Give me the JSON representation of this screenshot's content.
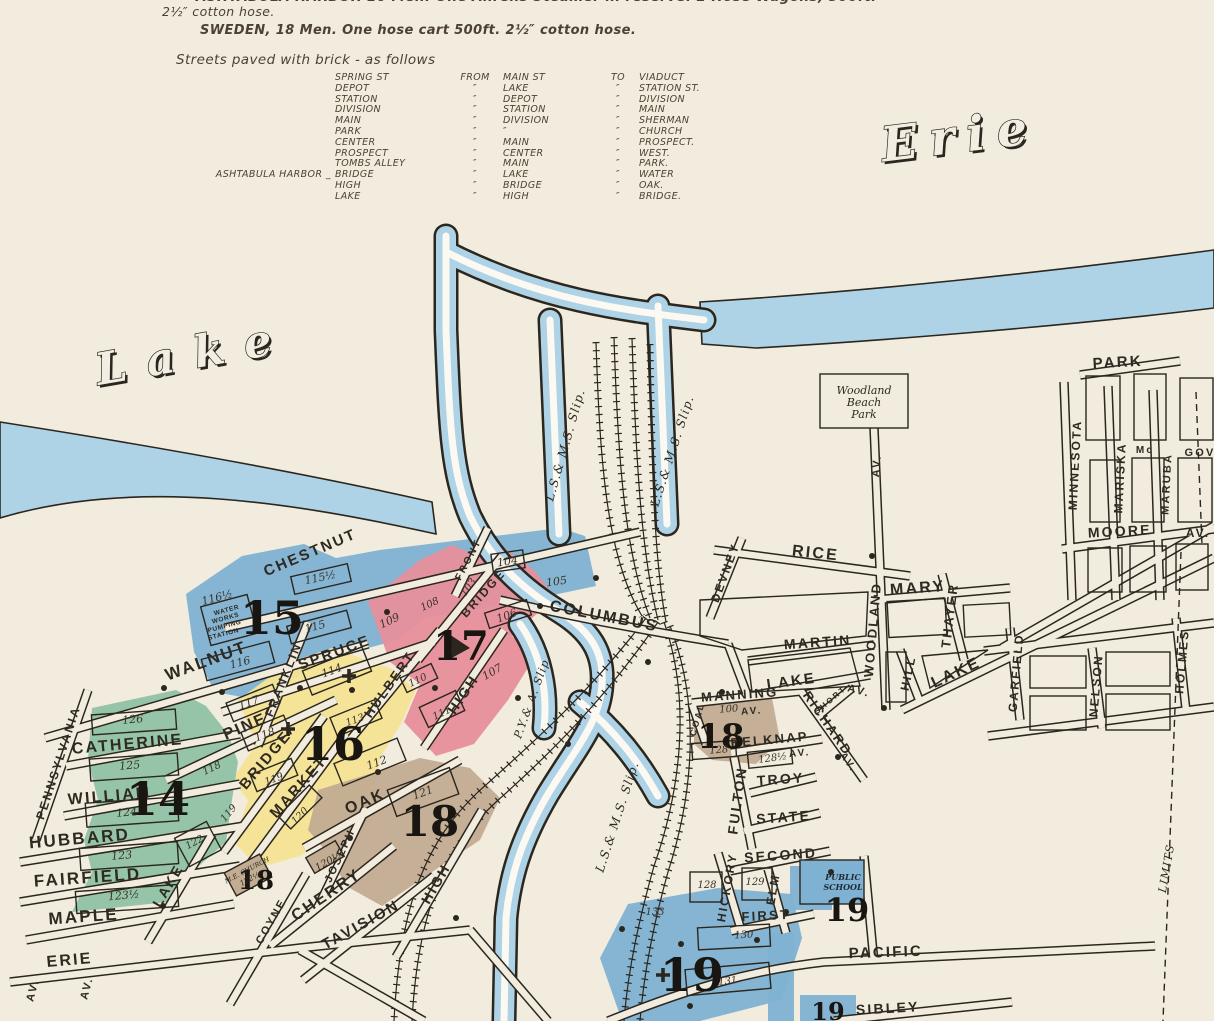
{
  "palette": {
    "paper": "#f1ecdd",
    "ink": "#2b261e",
    "text": "#4c4132",
    "water": "#aed2e6",
    "district_blue": "#7fb2d2",
    "district_pink": "#e78f9b",
    "district_yellow": "#f4e494",
    "district_green": "#90c2a4",
    "district_tan": "#c2ac92"
  },
  "header": {
    "line1": "ASHTABULA HARBOR 16 Men. One Ahrens Steamer in reserve. 2 Hose Wagons, 500ft.",
    "line2": "2½″ cotton hose.",
    "line3": "SWEDEN, 18 Men. One hose cart 500ft. 2½″ cotton hose.",
    "paved": {
      "title": "Streets paved with brick - as follows",
      "rows": [
        {
          "prefix": "",
          "street": "SPRING ST",
          "from": "FROM",
          "main": "MAIN ST",
          "to": "TO",
          "dest": "VIADUCT"
        },
        {
          "prefix": "",
          "street": "DEPOT",
          "from": "″",
          "main": "LAKE",
          "to": "″",
          "dest": "STATION ST."
        },
        {
          "prefix": "",
          "street": "STATION",
          "from": "″",
          "main": "DEPOT",
          "to": "″",
          "dest": "DIVISION"
        },
        {
          "prefix": "",
          "street": "DIVISION",
          "from": "″",
          "main": "STATION",
          "to": "″",
          "dest": "MAIN"
        },
        {
          "prefix": "",
          "street": "MAIN",
          "from": "″",
          "main": "DIVISION",
          "to": "″",
          "dest": "SHERMAN"
        },
        {
          "prefix": "",
          "street": "PARK",
          "from": "″",
          "main": "″",
          "to": "″",
          "dest": "CHURCH"
        },
        {
          "prefix": "",
          "street": "CENTER",
          "from": "″",
          "main": "MAIN",
          "to": "″",
          "dest": "PROSPECT."
        },
        {
          "prefix": "",
          "street": "PROSPECT",
          "from": "″",
          "main": "CENTER",
          "to": "″",
          "dest": "WEST."
        },
        {
          "prefix": "",
          "street": "TOMBS ALLEY",
          "from": "″",
          "main": "MAIN",
          "to": "″",
          "dest": "PARK."
        },
        {
          "prefix": "ASHTABULA HARBOR _",
          "street": "BRIDGE",
          "from": "″",
          "main": "LAKE",
          "to": "″",
          "dest": "WATER"
        },
        {
          "prefix": "",
          "street": "HIGH",
          "from": "″",
          "main": "BRIDGE",
          "to": "″",
          "dest": "OAK."
        },
        {
          "prefix": "",
          "street": "LAKE",
          "from": "″",
          "main": "HIGH",
          "to": "″",
          "dest": "BRIDGE."
        }
      ]
    }
  },
  "map": {
    "labels": [
      {
        "t": "Lake",
        "x": 196,
        "y": 368,
        "r": -10,
        "s": 44,
        "c": "water",
        "ls": 20
      },
      {
        "t": "Erie",
        "x": 962,
        "y": 152,
        "r": -7,
        "s": 48,
        "c": "water",
        "ls": 12
      },
      {
        "t": "CHESTNUT",
        "x": 312,
        "y": 557,
        "r": -23,
        "s": 15,
        "c": "st"
      },
      {
        "t": "WALNUT",
        "x": 208,
        "y": 666,
        "r": -20,
        "s": 17,
        "c": "st"
      },
      {
        "t": "SPRUCE",
        "x": 336,
        "y": 657,
        "r": -20,
        "s": 15,
        "c": "st"
      },
      {
        "t": "FRANKLIN",
        "x": 287,
        "y": 681,
        "r": -68,
        "s": 12,
        "c": "st"
      },
      {
        "t": "HULBERT",
        "x": 393,
        "y": 687,
        "r": -55,
        "s": 13,
        "c": "st"
      },
      {
        "t": "PINE",
        "x": 247,
        "y": 731,
        "r": -23,
        "s": 16,
        "c": "st"
      },
      {
        "t": "BRIDGE",
        "x": 269,
        "y": 763,
        "r": -50,
        "s": 15,
        "c": "st"
      },
      {
        "t": "MARKET",
        "x": 302,
        "y": 790,
        "r": -48,
        "s": 15,
        "c": "st"
      },
      {
        "t": "OAK",
        "x": 367,
        "y": 806,
        "r": -23,
        "s": 16,
        "c": "st"
      },
      {
        "t": "CHERRY",
        "x": 329,
        "y": 899,
        "r": -34,
        "s": 16,
        "c": "st"
      },
      {
        "t": "TAVISION",
        "x": 363,
        "y": 929,
        "r": -29,
        "s": 15,
        "c": "st"
      },
      {
        "t": "JOSEPH",
        "x": 343,
        "y": 857,
        "r": -65,
        "s": 11,
        "c": "st"
      },
      {
        "t": "COYNE",
        "x": 274,
        "y": 923,
        "r": -60,
        "s": 11,
        "c": "st"
      },
      {
        "t": "HIGH",
        "x": 467,
        "y": 697,
        "r": -56,
        "s": 14,
        "c": "st"
      },
      {
        "t": "HIGH",
        "x": 440,
        "y": 886,
        "r": -60,
        "s": 14,
        "c": "st"
      },
      {
        "t": "FRONT",
        "x": 471,
        "y": 561,
        "r": -62,
        "s": 10,
        "c": "st"
      },
      {
        "t": "BRIDGE",
        "x": 486,
        "y": 596,
        "r": -48,
        "s": 12,
        "c": "st"
      },
      {
        "t": "COLUMBUS",
        "x": 603,
        "y": 621,
        "r": 11,
        "s": 16,
        "c": "st"
      },
      {
        "t": "PENNSYLVANIA",
        "x": 62,
        "y": 764,
        "r": -72,
        "s": 12,
        "c": "st"
      },
      {
        "t": "CATHERINE",
        "x": 128,
        "y": 749,
        "r": -5,
        "s": 16,
        "c": "st"
      },
      {
        "t": "WILLIAM",
        "x": 110,
        "y": 801,
        "r": -5,
        "s": 16,
        "c": "st"
      },
      {
        "t": "HUBBARD",
        "x": 80,
        "y": 844,
        "r": -5,
        "s": 17,
        "c": "st"
      },
      {
        "t": "FAIRFIELD",
        "x": 88,
        "y": 883,
        "r": -4,
        "s": 17,
        "c": "st"
      },
      {
        "t": "MAPLE",
        "x": 84,
        "y": 922,
        "r": -4,
        "s": 17,
        "c": "st"
      },
      {
        "t": "ERIE",
        "x": 70,
        "y": 965,
        "r": -5,
        "s": 16,
        "c": "st"
      },
      {
        "t": "LAKE",
        "x": 172,
        "y": 888,
        "r": -60,
        "s": 14,
        "c": "st"
      },
      {
        "t": "AV.",
        "x": 36,
        "y": 991,
        "r": -75,
        "s": 11,
        "c": "st"
      },
      {
        "t": "AV.",
        "x": 90,
        "y": 989,
        "r": -75,
        "s": 11,
        "c": "st"
      },
      {
        "t": "RICE",
        "x": 815,
        "y": 558,
        "r": 6,
        "s": 16,
        "c": "st"
      },
      {
        "t": "DEVNEY",
        "x": 729,
        "y": 574,
        "r": -70,
        "s": 12,
        "c": "st"
      },
      {
        "t": "MARY",
        "x": 918,
        "y": 593,
        "r": -4,
        "s": 16,
        "c": "st"
      },
      {
        "t": "MARTIN",
        "x": 818,
        "y": 647,
        "r": -4,
        "s": 14,
        "c": "st"
      },
      {
        "t": "WOODLAND",
        "x": 877,
        "y": 630,
        "r": -85,
        "s": 13,
        "c": "st"
      },
      {
        "t": "AV.",
        "x": 858,
        "y": 694,
        "r": 15,
        "s": 11,
        "c": "st"
      },
      {
        "t": "AV.",
        "x": 880,
        "y": 466,
        "r": -85,
        "s": 11,
        "c": "st"
      },
      {
        "t": "HILL",
        "x": 912,
        "y": 674,
        "r": -78,
        "s": 12,
        "c": "st"
      },
      {
        "t": "THAYER",
        "x": 954,
        "y": 616,
        "r": -83,
        "s": 13,
        "c": "st"
      },
      {
        "t": "LAKE",
        "x": 792,
        "y": 686,
        "r": -8,
        "s": 15,
        "c": "st"
      },
      {
        "t": "LAKE",
        "x": 958,
        "y": 677,
        "r": -25,
        "s": 16,
        "c": "st"
      },
      {
        "t": "MANNING",
        "x": 740,
        "y": 699,
        "r": -4,
        "s": 13,
        "c": "st"
      },
      {
        "t": "AV.",
        "x": 752,
        "y": 714,
        "r": -4,
        "s": 10,
        "c": "st"
      },
      {
        "t": "RICHARD",
        "x": 824,
        "y": 726,
        "r": 55,
        "s": 13,
        "c": "st"
      },
      {
        "t": "AV.",
        "x": 846,
        "y": 764,
        "r": 55,
        "s": 10,
        "c": "st"
      },
      {
        "t": "SHORT",
        "x": 832,
        "y": 702,
        "r": -40,
        "s": 8,
        "c": "st"
      },
      {
        "t": "BELKNAP",
        "x": 770,
        "y": 744,
        "r": -5,
        "s": 13,
        "c": "st"
      },
      {
        "t": "AV.",
        "x": 800,
        "y": 756,
        "r": -5,
        "s": 10,
        "c": "st"
      },
      {
        "t": "TROY",
        "x": 781,
        "y": 784,
        "r": -4,
        "s": 14,
        "c": "st"
      },
      {
        "t": "STATE",
        "x": 784,
        "y": 822,
        "r": -4,
        "s": 14,
        "c": "st"
      },
      {
        "t": "FULTON",
        "x": 742,
        "y": 801,
        "r": -82,
        "s": 14,
        "c": "st"
      },
      {
        "t": "SECOND",
        "x": 781,
        "y": 860,
        "r": -4,
        "s": 14,
        "c": "st"
      },
      {
        "t": "HICKORY",
        "x": 731,
        "y": 888,
        "r": -80,
        "s": 12,
        "c": "st"
      },
      {
        "t": "ELM",
        "x": 777,
        "y": 890,
        "r": -80,
        "s": 12,
        "c": "st"
      },
      {
        "t": "FIRST",
        "x": 766,
        "y": 920,
        "r": -3,
        "s": 13,
        "c": "st"
      },
      {
        "t": "PACIFIC",
        "x": 886,
        "y": 957,
        "r": -2,
        "s": 15,
        "c": "st"
      },
      {
        "t": "SIBLEY",
        "x": 888,
        "y": 1013,
        "r": -3,
        "s": 14,
        "c": "st"
      },
      {
        "t": "COAL",
        "x": 700,
        "y": 720,
        "r": -75,
        "s": 9,
        "c": "st"
      },
      {
        "t": "PARK",
        "x": 1118,
        "y": 367,
        "r": -3,
        "s": 15,
        "c": "st"
      },
      {
        "t": "MINNESOTA",
        "x": 1079,
        "y": 465,
        "r": -87,
        "s": 12,
        "c": "st"
      },
      {
        "t": "MARISKA",
        "x": 1124,
        "y": 478,
        "r": -87,
        "s": 12,
        "c": "st"
      },
      {
        "t": "Mc",
        "x": 1145,
        "y": 453,
        "r": 0,
        "s": 10,
        "c": "st"
      },
      {
        "t": "MARUBA",
        "x": 1170,
        "y": 484,
        "r": -87,
        "s": 11,
        "c": "st"
      },
      {
        "t": "GOV",
        "x": 1200,
        "y": 456,
        "r": 0,
        "s": 11,
        "c": "st"
      },
      {
        "t": "MOORE",
        "x": 1120,
        "y": 536,
        "r": -3,
        "s": 14,
        "c": "st"
      },
      {
        "t": "AV.",
        "x": 1198,
        "y": 537,
        "r": 0,
        "s": 12,
        "c": "st"
      },
      {
        "t": "GARFIELD",
        "x": 1020,
        "y": 673,
        "r": -85,
        "s": 12,
        "c": "st"
      },
      {
        "t": "NELSON",
        "x": 1100,
        "y": 686,
        "r": -85,
        "s": 12,
        "c": "st"
      },
      {
        "t": "HOLMES",
        "x": 1186,
        "y": 662,
        "r": -85,
        "s": 12,
        "c": "st"
      },
      {
        "t": "LIMITS",
        "x": 1170,
        "y": 869,
        "r": -80,
        "s": 11,
        "c": "slip"
      },
      {
        "t": "L.S.& M.S. Slip.",
        "x": 569,
        "y": 446,
        "r": -74,
        "s": 12,
        "c": "slip"
      },
      {
        "t": "L.S.& M.S. Slip.",
        "x": 676,
        "y": 452,
        "r": -72,
        "s": 12,
        "c": "slip"
      },
      {
        "t": "L.S.& M.S. Slip.",
        "x": 621,
        "y": 818,
        "r": -72,
        "s": 12,
        "c": "slip"
      },
      {
        "t": "P.Y.& A. Slip",
        "x": 535,
        "y": 700,
        "r": -70,
        "s": 11,
        "c": "slip"
      },
      {
        "t": "15",
        "x": 272,
        "y": 634,
        "r": 0,
        "s": 46,
        "c": "big"
      },
      {
        "t": "17",
        "x": 461,
        "y": 660,
        "r": 0,
        "s": 40,
        "c": "big"
      },
      {
        "t": "16",
        "x": 333,
        "y": 760,
        "r": 0,
        "s": 46,
        "c": "big"
      },
      {
        "t": "14",
        "x": 158,
        "y": 815,
        "r": 0,
        "s": 46,
        "c": "big"
      },
      {
        "t": "18",
        "x": 430,
        "y": 836,
        "r": 0,
        "s": 42,
        "c": "big"
      },
      {
        "t": "18",
        "x": 256,
        "y": 889,
        "r": 0,
        "s": 26,
        "c": "big"
      },
      {
        "t": "18",
        "x": 721,
        "y": 748,
        "r": 0,
        "s": 34,
        "c": "big"
      },
      {
        "t": "19",
        "x": 847,
        "y": 921,
        "r": 0,
        "s": 32,
        "c": "big"
      },
      {
        "t": "19",
        "x": 692,
        "y": 991,
        "r": 0,
        "s": 46,
        "c": "big"
      },
      {
        "t": "19",
        "x": 828,
        "y": 1020,
        "r": 0,
        "s": 24,
        "c": "big"
      },
      {
        "t": "116½",
        "x": 218,
        "y": 601,
        "r": -15,
        "s": 11,
        "c": "blk"
      },
      {
        "t": "115½",
        "x": 321,
        "y": 581,
        "r": -12,
        "s": 11,
        "c": "blk"
      },
      {
        "t": "115",
        "x": 316,
        "y": 630,
        "r": -15,
        "s": 11,
        "c": "blk"
      },
      {
        "t": "116",
        "x": 241,
        "y": 666,
        "r": -15,
        "s": 11,
        "c": "blk"
      },
      {
        "t": "109",
        "x": 391,
        "y": 624,
        "r": -25,
        "s": 11,
        "c": "blk"
      },
      {
        "t": "108",
        "x": 431,
        "y": 607,
        "r": -25,
        "s": 10,
        "c": "blk"
      },
      {
        "t": "103",
        "x": 471,
        "y": 589,
        "r": -55,
        "s": 10,
        "c": "blk"
      },
      {
        "t": "104",
        "x": 508,
        "y": 565,
        "r": -8,
        "s": 11,
        "c": "blk"
      },
      {
        "t": "105",
        "x": 557,
        "y": 585,
        "r": -8,
        "s": 11,
        "c": "blk"
      },
      {
        "t": "106",
        "x": 508,
        "y": 619,
        "r": -20,
        "s": 11,
        "c": "blk"
      },
      {
        "t": "107",
        "x": 494,
        "y": 675,
        "r": -30,
        "s": 11,
        "c": "blk"
      },
      {
        "t": "110",
        "x": 419,
        "y": 683,
        "r": -25,
        "s": 10,
        "c": "blk"
      },
      {
        "t": "111",
        "x": 443,
        "y": 716,
        "r": -25,
        "s": 10,
        "c": "blk"
      },
      {
        "t": "114",
        "x": 333,
        "y": 674,
        "r": -20,
        "s": 11,
        "c": "blk"
      },
      {
        "t": "117",
        "x": 250,
        "y": 706,
        "r": -20,
        "s": 11,
        "c": "blk"
      },
      {
        "t": "118",
        "x": 266,
        "y": 738,
        "r": -20,
        "s": 11,
        "c": "blk"
      },
      {
        "t": "113",
        "x": 356,
        "y": 723,
        "r": -20,
        "s": 10,
        "c": "blk"
      },
      {
        "t": "112",
        "x": 378,
        "y": 766,
        "r": -20,
        "s": 11,
        "c": "blk"
      },
      {
        "t": "119",
        "x": 275,
        "y": 782,
        "r": -20,
        "s": 10,
        "c": "blk"
      },
      {
        "t": "119",
        "x": 231,
        "y": 815,
        "r": -50,
        "s": 10,
        "c": "blk"
      },
      {
        "t": "120",
        "x": 302,
        "y": 818,
        "r": -45,
        "s": 10,
        "c": "blk"
      },
      {
        "t": "120½",
        "x": 330,
        "y": 864,
        "r": -30,
        "s": 10,
        "c": "blk"
      },
      {
        "t": "121",
        "x": 424,
        "y": 796,
        "r": -20,
        "s": 11,
        "c": "blk"
      },
      {
        "t": "126",
        "x": 133,
        "y": 723,
        "r": -5,
        "s": 11,
        "c": "blk"
      },
      {
        "t": "125",
        "x": 130,
        "y": 769,
        "r": -5,
        "s": 11,
        "c": "blk"
      },
      {
        "t": "124",
        "x": 127,
        "y": 816,
        "r": -5,
        "s": 11,
        "c": "blk"
      },
      {
        "t": "123",
        "x": 122,
        "y": 859,
        "r": -5,
        "s": 11,
        "c": "blk"
      },
      {
        "t": "123½",
        "x": 124,
        "y": 899,
        "r": -5,
        "s": 11,
        "c": "blk"
      },
      {
        "t": "122",
        "x": 196,
        "y": 845,
        "r": -28,
        "s": 10,
        "c": "blk"
      },
      {
        "t": "118",
        "x": 213,
        "y": 771,
        "r": -25,
        "s": 10,
        "c": "blk"
      },
      {
        "t": "100",
        "x": 729,
        "y": 712,
        "r": -4,
        "s": 10,
        "c": "blk"
      },
      {
        "t": "128",
        "x": 719,
        "y": 753,
        "r": -4,
        "s": 10,
        "c": "blk"
      },
      {
        "t": "128½",
        "x": 773,
        "y": 761,
        "r": -8,
        "s": 10,
        "c": "blk"
      },
      {
        "t": "128",
        "x": 707,
        "y": 888,
        "r": 0,
        "s": 10,
        "c": "blk"
      },
      {
        "t": "129",
        "x": 755,
        "y": 885,
        "r": 0,
        "s": 10,
        "c": "blk"
      },
      {
        "t": "130",
        "x": 744,
        "y": 938,
        "r": -3,
        "s": 10,
        "c": "blk"
      },
      {
        "t": "131",
        "x": 728,
        "y": 984,
        "r": -6,
        "s": 10,
        "c": "blk"
      },
      {
        "t": "133",
        "x": 655,
        "y": 915,
        "r": 0,
        "s": 10,
        "c": "blk"
      },
      {
        "t": "WATER",
        "x": 227,
        "y": 612,
        "r": -15,
        "s": 6.5,
        "c": "note"
      },
      {
        "t": "WORKS",
        "x": 226,
        "y": 620,
        "r": -15,
        "s": 6.5,
        "c": "note"
      },
      {
        "t": "PUMPING",
        "x": 225,
        "y": 628,
        "r": -15,
        "s": 6.5,
        "c": "note"
      },
      {
        "t": "STATION",
        "x": 224,
        "y": 636,
        "r": -15,
        "s": 6.5,
        "c": "note"
      },
      {
        "t": "Woodland",
        "x": 864,
        "y": 394,
        "r": 0,
        "s": 11,
        "c": "park"
      },
      {
        "t": "Beach",
        "x": 864,
        "y": 406,
        "r": 0,
        "s": 11,
        "c": "park"
      },
      {
        "t": "Park",
        "x": 864,
        "y": 418,
        "r": 0,
        "s": 11,
        "c": "park"
      },
      {
        "t": "PUBLIC",
        "x": 843,
        "y": 880,
        "r": 0,
        "s": 8,
        "c": "school"
      },
      {
        "t": "SCHOOL",
        "x": 843,
        "y": 890,
        "r": 0,
        "s": 8,
        "c": "school"
      },
      {
        "t": "M.E. CHURCH",
        "x": 248,
        "y": 872,
        "r": -28,
        "s": 6.5,
        "c": "church"
      },
      {
        "t": "122½",
        "x": 251,
        "y": 881,
        "r": -28,
        "s": 7.5,
        "c": "church"
      }
    ]
  }
}
